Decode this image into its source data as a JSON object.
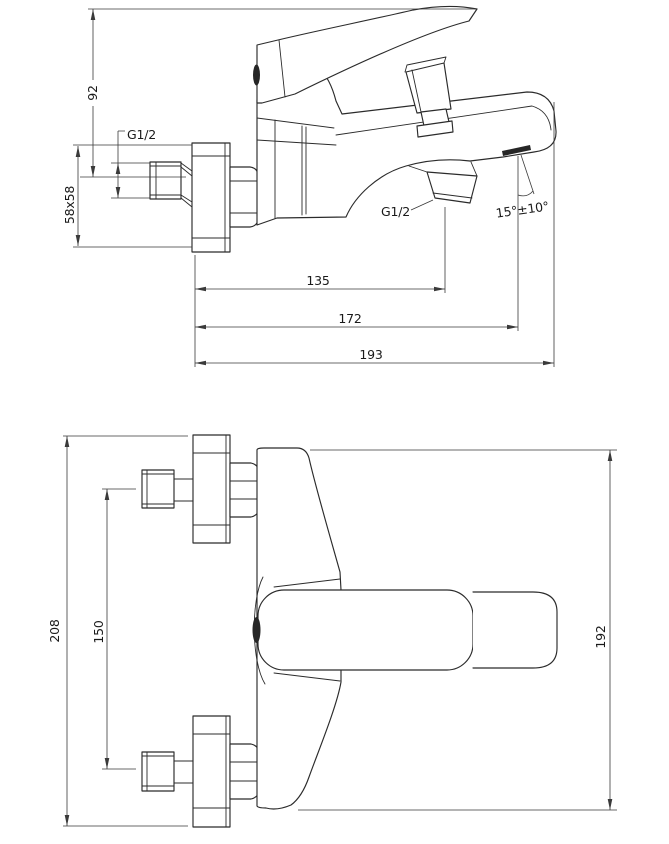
{
  "title": "Bath mixer tap - dimensional technical drawing",
  "colors": {
    "background": "#ffffff",
    "object_line": "#2b2b2b",
    "dimension_line": "#3a3a3a",
    "text": "#1a1a1a",
    "dark_fill": "#262626"
  },
  "side_view": {
    "name": "side view",
    "dimensions": {
      "height": "92",
      "escutcheon": "58x58",
      "inlet_thread": "G1/2",
      "outlet_thread": "G1/2",
      "spout_angle": "15°±10°",
      "dist_outlet": "135",
      "dist_aerator": "172",
      "dist_tip": "193"
    }
  },
  "front_view": {
    "name": "front view",
    "dimensions": {
      "overall_height": "208",
      "inlet_spacing": "150",
      "body_height": "192"
    }
  }
}
